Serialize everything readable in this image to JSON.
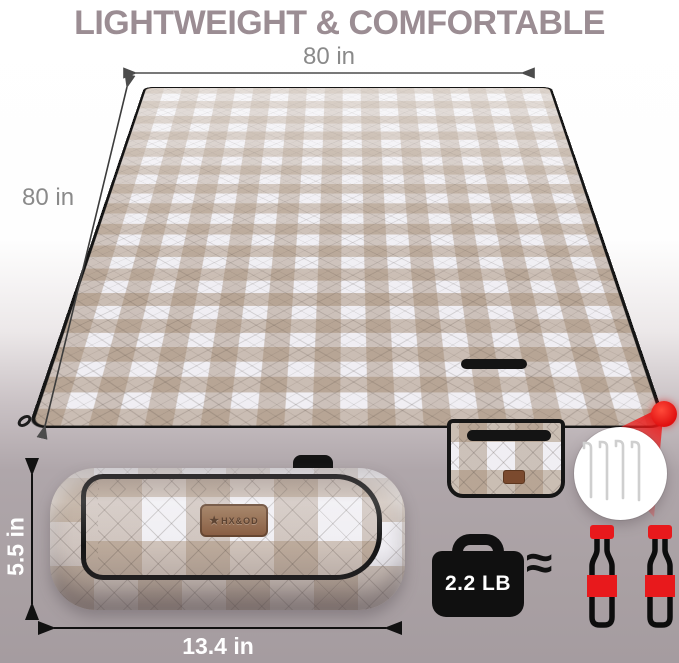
{
  "title": "LIGHTWEIGHT & COMFORTABLE",
  "blanket": {
    "width_label": "80 in",
    "height_label": "80 in",
    "pattern": "tan-white gingham check, quilted diamond stitching",
    "corner_callout_item": "ground stakes"
  },
  "roll": {
    "height_label": "5.5 in",
    "width_label": "13.4 in",
    "brand": "HX&OD",
    "brand_star": "★"
  },
  "weight": {
    "label": "2.2 LB",
    "approx_symbol": "≈",
    "comparison": "two soda bottles"
  },
  "icons": {
    "weight": "kettlebell-weight-icon",
    "bottle": "soda-bottle-icon",
    "stakes": "tent-stakes-icon",
    "corner_dot": "corner-highlight-dot",
    "brand_mark": "star-icon"
  },
  "colors": {
    "title_text": "#9b8d93",
    "dimension_text": "#8a8a8a",
    "accent_red": "#e8191c",
    "gingham_tan": "#b09a87",
    "trim_black": "#151515",
    "label_brown": "#84573b",
    "background_bottom": "#a59ca0"
  }
}
